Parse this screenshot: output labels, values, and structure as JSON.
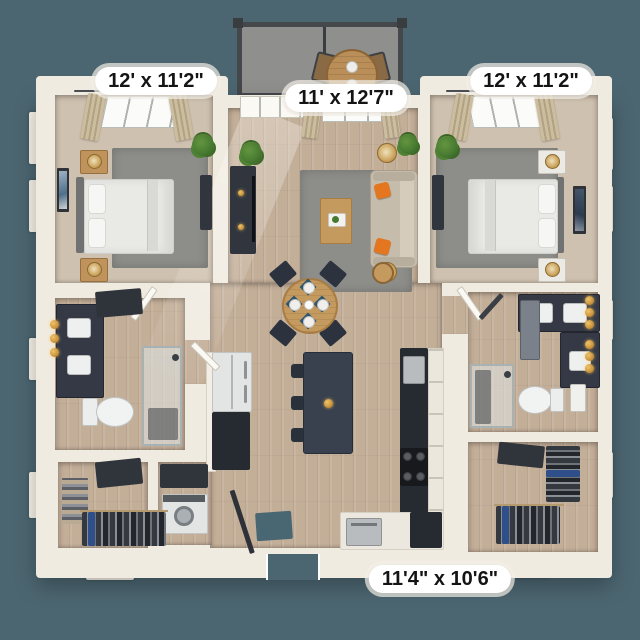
{
  "colors": {
    "background": "#4c6671",
    "wall": "#f0ebe1",
    "wall_shadow": "#d9d3c6",
    "wood": "#c3ae98",
    "carpet": "#cfc1af",
    "rug": "#8d8d89",
    "counter_dark": "#262b31",
    "island": "#39414e",
    "sofa": "#c6bcab",
    "accent_orange": "#e4761f",
    "table_wood": "#c59a5f",
    "gold": "#cf943f",
    "plant_green": "#477a31",
    "balcony_floor": "#8f908e",
    "railing": "#45484b",
    "label_bg": "#ffffff",
    "label_text": "#141414"
  },
  "labels": {
    "bedroom_left": "12' x 11'2\"",
    "living_room": "11' x 12'7\"",
    "bedroom_right": "12' x 11'2\"",
    "bottom_room": "11'4\" x 10'6\""
  }
}
